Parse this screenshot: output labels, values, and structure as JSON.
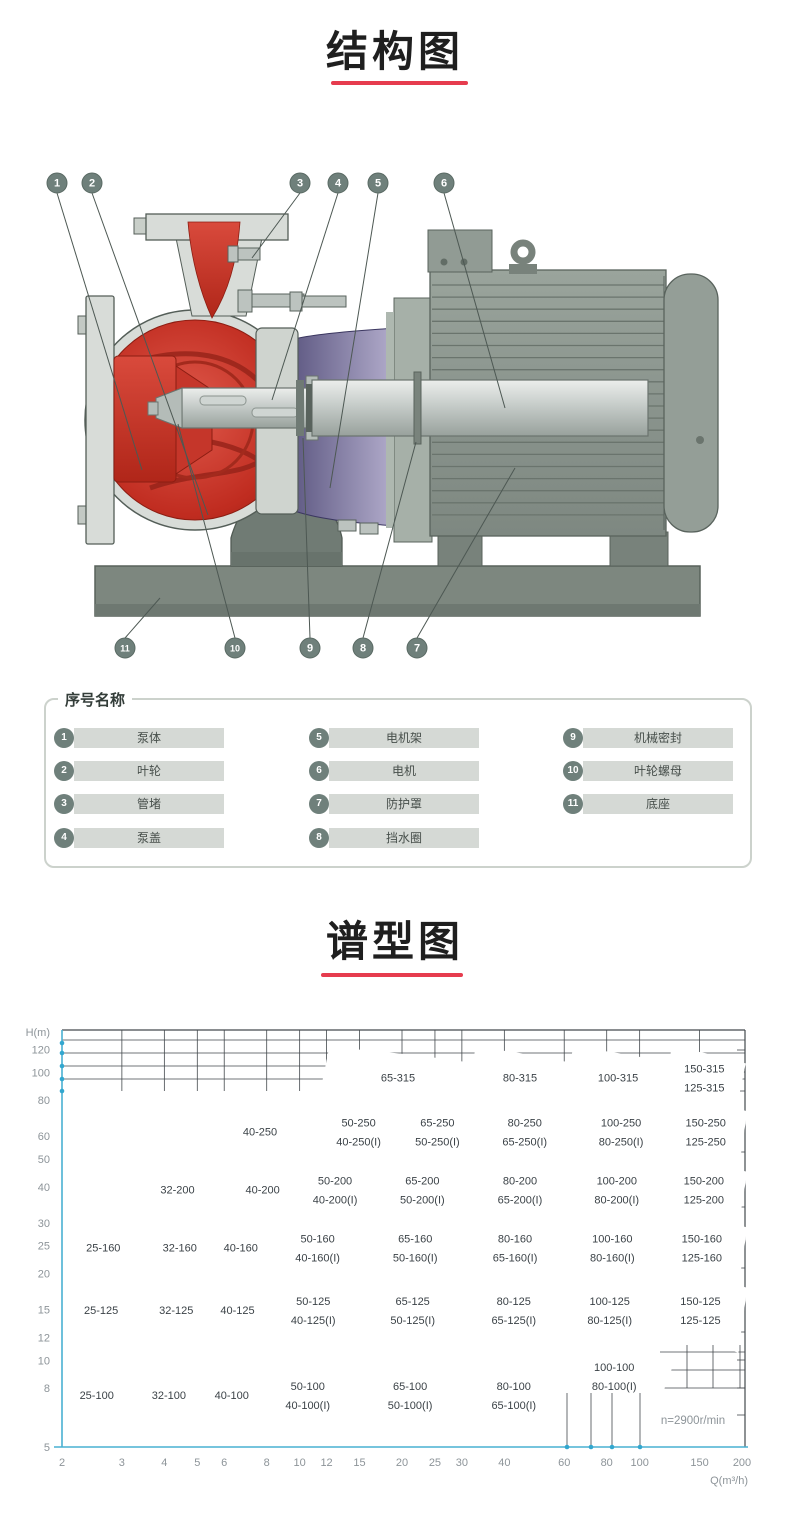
{
  "sections": {
    "structure": {
      "title": "结构图"
    },
    "spectrum": {
      "title": "谱型图"
    }
  },
  "accent": {
    "underline": "#e63c4e",
    "callout_fill": "#6f807b",
    "part_bar": "#d5d9d5",
    "chart_line": "#4fb3d5",
    "grid_color": "#43494d",
    "axis_cyan": "#49b0d2",
    "dot_cyan": "#33a7cf",
    "pump_red": "#c02c20",
    "bracket_purple": "#46416e",
    "motor_gray": "#8f9992"
  },
  "parts": {
    "title": "序号名称",
    "items": [
      {
        "no": "1",
        "name": "泵体"
      },
      {
        "no": "2",
        "name": "叶轮"
      },
      {
        "no": "3",
        "name": "管堵"
      },
      {
        "no": "4",
        "name": "泵盖"
      },
      {
        "no": "5",
        "name": "电机架"
      },
      {
        "no": "6",
        "name": "电机"
      },
      {
        "no": "7",
        "name": "防护罩"
      },
      {
        "no": "8",
        "name": "挡水圈"
      },
      {
        "no": "9",
        "name": "机械密封"
      },
      {
        "no": "10",
        "name": "叶轮螺母"
      },
      {
        "no": "11",
        "name": "底座"
      }
    ]
  },
  "diagram": {
    "callouts": [
      {
        "n": "1",
        "x": 57,
        "y": 183,
        "tx": 142,
        "ty": 470
      },
      {
        "n": "2",
        "x": 92,
        "y": 183,
        "tx": 208,
        "ty": 515
      },
      {
        "n": "3",
        "x": 300,
        "y": 183,
        "tx": 252,
        "ty": 258
      },
      {
        "n": "4",
        "x": 338,
        "y": 183,
        "tx": 272,
        "ty": 400
      },
      {
        "n": "5",
        "x": 378,
        "y": 183,
        "tx": 330,
        "ty": 488
      },
      {
        "n": "6",
        "x": 444,
        "y": 183,
        "tx": 505,
        "ty": 408
      },
      {
        "n": "11",
        "x": 125,
        "y": 648,
        "tx": 160,
        "ty": 598
      },
      {
        "n": "10",
        "x": 235,
        "y": 648,
        "tx": 178,
        "ty": 424
      },
      {
        "n": "9",
        "x": 310,
        "y": 648,
        "tx": 303,
        "ty": 438
      },
      {
        "n": "8",
        "x": 363,
        "y": 648,
        "tx": 416,
        "ty": 442
      },
      {
        "n": "7",
        "x": 417,
        "y": 648,
        "tx": 515,
        "ty": 468
      }
    ]
  },
  "chart_data": {
    "type": "area",
    "subtype": "pump-selection-map",
    "title": "谱型图",
    "xlabel": "Q(m³/h)",
    "ylabel": "H(m)",
    "x_scale": "log",
    "y_scale": "log",
    "x_range": [
      2,
      200
    ],
    "y_range": [
      5,
      140
    ],
    "x_ticks": [
      2,
      3,
      4,
      5,
      6,
      8,
      10,
      12,
      15,
      20,
      25,
      30,
      40,
      60,
      80,
      100,
      150,
      200
    ],
    "y_ticks": [
      120,
      100,
      80,
      60,
      50,
      40,
      30,
      25,
      20,
      15,
      12,
      10,
      8,
      5
    ],
    "annotation": "n=2900r/min",
    "rows": [
      {
        "h_top": 122,
        "h_bot": 86,
        "droop": 0.88,
        "cells": [
          {
            "q1": 11.5,
            "q2": 31,
            "labels": [
              "65-315"
            ]
          },
          {
            "q1": 31,
            "q2": 60,
            "labels": [
              "80-315"
            ]
          },
          {
            "q1": 60,
            "q2": 117,
            "labels": [
              "100-315"
            ]
          },
          {
            "q1": 117,
            "q2": 193,
            "labels": [
              "150-315",
              "125-315"
            ]
          }
        ]
      },
      {
        "h_top": 86,
        "h_bot": 53,
        "droop": 0.85,
        "extend_left": true,
        "cells": [
          {
            "q1": 5,
            "q2": 11,
            "labels": [
              "40-250"
            ]
          },
          {
            "q1": 11,
            "q2": 19,
            "labels": [
              "50-250",
              "40-250(I)"
            ]
          },
          {
            "q1": 19,
            "q2": 32,
            "labels": [
              "65-250",
              "50-250(I)"
            ]
          },
          {
            "q1": 32,
            "q2": 62,
            "labels": [
              "80-250",
              "65-250(I)"
            ]
          },
          {
            "q1": 62,
            "q2": 118,
            "labels": [
              "100-250",
              "80-250(I)"
            ]
          },
          {
            "q1": 118,
            "q2": 195,
            "labels": [
              "150-250",
              "125-250"
            ]
          }
        ]
      },
      {
        "h_top": 53,
        "h_bot": 34,
        "droop": 0.85,
        "extend_left": true,
        "cells": [
          {
            "q1": 3,
            "q2": 6,
            "labels": [
              "32-200"
            ]
          },
          {
            "q1": 6,
            "q2": 9.5,
            "labels": [
              "40-200"
            ]
          },
          {
            "q1": 9.5,
            "q2": 16,
            "labels": [
              "50-200",
              "40-200(I)"
            ]
          },
          {
            "q1": 16,
            "q2": 31,
            "labels": [
              "65-200",
              "50-200(I)"
            ]
          },
          {
            "q1": 31,
            "q2": 60,
            "labels": [
              "80-200",
              "65-200(I)"
            ]
          },
          {
            "q1": 60,
            "q2": 115,
            "labels": [
              "100-200",
              "80-200(I)"
            ]
          },
          {
            "q1": 115,
            "q2": 195,
            "labels": [
              "150-200",
              "125-200"
            ]
          }
        ]
      },
      {
        "h_top": 34,
        "h_bot": 21,
        "droop": 0.85,
        "cells": [
          {
            "q1": 2,
            "q2": 3.5,
            "labels": [
              "25-160"
            ]
          },
          {
            "q1": 3.5,
            "q2": 5.3,
            "labels": [
              "32-160"
            ]
          },
          {
            "q1": 5.3,
            "q2": 8,
            "labels": [
              "40-160"
            ]
          },
          {
            "q1": 8,
            "q2": 15,
            "labels": [
              "50-160",
              "40-160(I)"
            ]
          },
          {
            "q1": 15,
            "q2": 30,
            "labels": [
              "65-160",
              "50-160(I)"
            ]
          },
          {
            "q1": 30,
            "q2": 58,
            "labels": [
              "80-160",
              "65-160(I)"
            ]
          },
          {
            "q1": 58,
            "q2": 112,
            "labels": [
              "100-160",
              "80-160(I)"
            ]
          },
          {
            "q1": 112,
            "q2": 195,
            "labels": [
              "150-160",
              "125-160"
            ]
          }
        ]
      },
      {
        "h_top": 21,
        "h_bot": 12.5,
        "droop": 0.85,
        "cells": [
          {
            "q1": 2,
            "q2": 3.4,
            "labels": [
              "25-125"
            ]
          },
          {
            "q1": 3.4,
            "q2": 5.2,
            "labels": [
              "32-125"
            ]
          },
          {
            "q1": 5.2,
            "q2": 7.8,
            "labels": [
              "40-125"
            ]
          },
          {
            "q1": 7.8,
            "q2": 14.5,
            "labels": [
              "50-125",
              "40-125(I)"
            ]
          },
          {
            "q1": 14.5,
            "q2": 30,
            "labels": [
              "65-125",
              "50-125(I)"
            ]
          },
          {
            "q1": 30,
            "q2": 57,
            "labels": [
              "80-125",
              "65-125(I)"
            ]
          },
          {
            "q1": 57,
            "q2": 110,
            "labels": [
              "100-125",
              "80-125(I)"
            ]
          },
          {
            "q1": 110,
            "q2": 195,
            "labels": [
              "150-125",
              "125-125"
            ]
          }
        ]
      },
      {
        "h_top": 12.5,
        "h_bot": 5,
        "droop": 0.85,
        "flat_bottom": true,
        "cells": [
          {
            "q1": 2,
            "q2": 3.2,
            "labels": [
              "25-100"
            ]
          },
          {
            "q1": 3.2,
            "q2": 5,
            "labels": [
              "32-100"
            ]
          },
          {
            "q1": 5,
            "q2": 7.5,
            "labels": [
              "40-100"
            ]
          },
          {
            "q1": 7.5,
            "q2": 14,
            "labels": [
              "50-100",
              "40-100(I)"
            ]
          },
          {
            "q1": 14,
            "q2": 30,
            "labels": [
              "65-100",
              "50-100(I)"
            ]
          },
          {
            "q1": 30,
            "q2": 57,
            "labels": [
              "80-100",
              "65-100(I)"
            ]
          },
          {
            "q1": 57,
            "q2": 117,
            "labels": [
              "100-100",
              "80-100(I)"
            ],
            "h_top": 11,
            "h_bot": 7.7
          }
        ]
      }
    ]
  }
}
